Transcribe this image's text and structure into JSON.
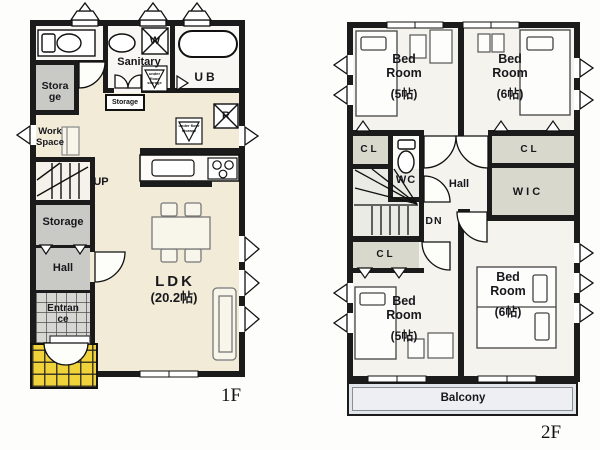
{
  "title": "Residential floor plan, 1F and 2F",
  "floor1": {
    "floor_label": "1F",
    "sanitary": "Sanitary",
    "washer": "W",
    "bath": "UB",
    "storage_top": "Storage",
    "storage_small": "Storage",
    "workspace": "Work Space",
    "stairs_up": "UP",
    "storage_mid": "Storage",
    "hall": "Hall",
    "entrance": "Entrance",
    "ldk": "LDK",
    "ldk_size": "(20.2帖)",
    "fridge": "R",
    "underfloor_storage": "under floor storage"
  },
  "floor2": {
    "floor_label": "2F",
    "bedroom_tl": {
      "name": "Bed Room",
      "size": "(5帖)"
    },
    "bedroom_tr": {
      "name": "Bed Room",
      "size": "(6帖)"
    },
    "bedroom_bl": {
      "name": "Bed Room",
      "size": "(5帖)"
    },
    "bedroom_br": {
      "name": "Bed Room",
      "size": "(6帖)"
    },
    "closet_left": "CL",
    "closet_right": "CL",
    "closet_bottom": "CL",
    "wc": "WC",
    "wic": "WIC",
    "hall": "Hall",
    "stairs_down": "DN",
    "balcony": "Balcony"
  },
  "colors": {
    "wall": "#1b1b1b",
    "ldk_floor": "#f1ebd8",
    "gray_floor": "#c9c9c5",
    "tile_yellow": "#f0d23a",
    "closet_fill": "#d8d8cc",
    "balcony_fill": "#e2e5ea"
  }
}
